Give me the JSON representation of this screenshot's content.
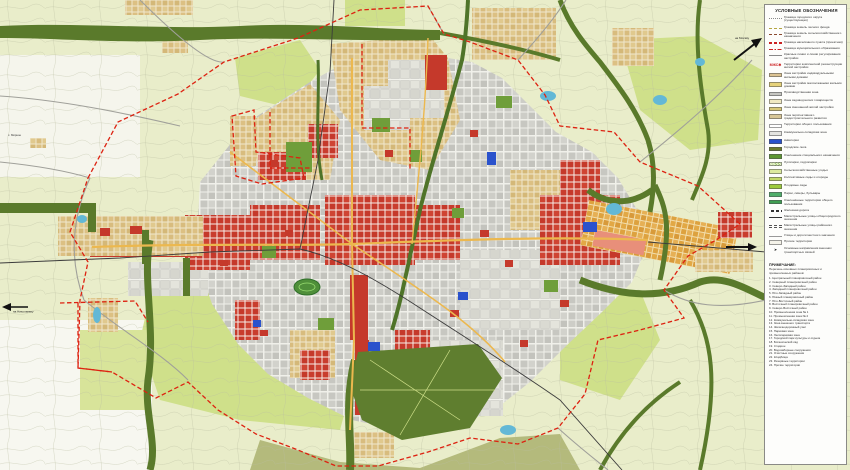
{
  "panel": {
    "title": "УСЛОВНЫЕ ОБОЗНАЧЕНИЯ",
    "legend": [
      {
        "type": "line",
        "dash": "dotted",
        "color": "#8a8a8a",
        "label": "Граница городского округа (существующая)"
      },
      {
        "type": "line",
        "dash": "dashed",
        "color": "#b5a642",
        "label": "Граница земель лесного фонда"
      },
      {
        "type": "line",
        "dash": "dashed",
        "color": "#8b4a2e",
        "label": "Граница земель сельскохозяйственного назначения"
      },
      {
        "type": "line2",
        "color": "#cc2222",
        "label": "Граница населённого пункта (проектная)"
      },
      {
        "type": "line",
        "dash": "dashdot",
        "color": "#cc2222",
        "label": "Граница муниципального образования"
      },
      {
        "type": "line",
        "dash": "solid",
        "color": "#888888",
        "label": "Красные линии и линии регулирования застройки"
      },
      {
        "type": "symbol",
        "symbol": "МЖС✱",
        "color": "#cc2222",
        "label": "Территории комплексной реконструкции жилой застройки"
      },
      {
        "type": "fill",
        "color": "#dcc392",
        "label": "Зона застройки индивидуальными жилыми домами"
      },
      {
        "type": "fill",
        "color": "#e6d27a",
        "label": "Зона застройки малоэтажными жилыми домами"
      },
      {
        "type": "fill",
        "color": "#c6c6c0",
        "label": "Производственная зона"
      },
      {
        "type": "fill",
        "color": "#f0e9c2",
        "label": "Зона садоводческих товариществ"
      },
      {
        "type": "fill",
        "color": "#d8c878",
        "label": "Зона смешанной жилой застройки"
      },
      {
        "type": "fill",
        "color": "#e8dcb0",
        "pattern": "dots",
        "label": "Зона перспективного градостроительного развития"
      },
      {
        "type": "fill",
        "color": "#ffffff",
        "label": "Территории общего пользования"
      },
      {
        "type": "fill",
        "color": "#e4e4e0",
        "label": "Коммунально-складская зона"
      },
      {
        "type": "fill",
        "color": "#2a52cc",
        "label": "Акватории"
      },
      {
        "type": "fill",
        "color": "#6b7c2e",
        "label": "Городские леса"
      },
      {
        "type": "fill",
        "color": "#5d9732",
        "label": "Озеленение специального назначения"
      },
      {
        "type": "fill",
        "color": "#e8f2cc",
        "pattern": "hatch",
        "label": "Лугопарки, гидропарки"
      },
      {
        "type": "fill",
        "color": "#dcea9e",
        "label": "Сельскохозяйственные угодья"
      },
      {
        "type": "fill",
        "color": "#c3d96a",
        "label": "Коллективные сады и огороды"
      },
      {
        "type": "fill",
        "color": "#9ccb3c",
        "label": "Плодовые сады"
      },
      {
        "type": "fill",
        "color": "#4fae6a",
        "label": "Парки, скверы, бульвары"
      },
      {
        "type": "fill",
        "color": "#3f9e52",
        "label": "Озеленённые территории общего пользования"
      },
      {
        "type": "rail",
        "color": "#333333",
        "label": "Железная дорога"
      },
      {
        "type": "line",
        "dash": "solid",
        "color": "#333333",
        "label": "Магистральные улицы общегородского значения"
      },
      {
        "type": "line2",
        "color": "#555555",
        "label": "Магистральные улицы районного значения"
      },
      {
        "type": "line",
        "dash": "solid",
        "color": "#999999",
        "label": "Улицы и дороги местного значения"
      },
      {
        "type": "fill",
        "color": "#f4f2e8",
        "label": "Прочие территории"
      },
      {
        "type": "arrow",
        "color": "#222222",
        "label": "Основные направления внешних транспортных связей"
      }
    ],
    "notes": {
      "title": "ПРИМЕЧАНИЕ:",
      "subtitle": "Перечень основных планировочных и промышленных районов:",
      "items": [
        "1. Центральный планировочный район",
        "2. Северный планировочный район",
        "3. Северо-Западный район",
        "4. Западный планировочный район",
        "5. Юго-Западный район",
        "6. Южный планировочный район",
        "7. Юго-Восточный район",
        "8. Восточный планировочный район",
        "9. Северо-Восточный район",
        "10. Промышленная зона № 1",
        "11. Промышленная зона № 2",
        "12. Коммунально-складская зона",
        "13. Зона внешнего транспорта",
        "14. Железнодорожный узел",
        "15. Парковая зона",
        "16. Лесопарковая зона",
        "17. Городской парк культуры и отдыха",
        "18. Ботанический сад",
        "19. Стадион",
        "20. Водозаборные сооружения",
        "21. Очистные сооружения",
        "22. Кладбища",
        "23. Резервные территории",
        "24. Прочие территории"
      ]
    }
  },
  "map": {
    "labels": {
      "village": "с. Мирное",
      "dir_west": "на Николаевку",
      "dir_ne": "на Москву"
    },
    "palette": {
      "fields": "#e9edca",
      "orchards": "#cfe08a",
      "forest": "#5a7a2b",
      "city_blocks": "#c9c9c3",
      "residential_new": "#c5392b",
      "individual_housing": "#dcc083",
      "water": "#2a52cc",
      "boundary": "#dd2211",
      "main_road": "#ecb84e"
    }
  }
}
